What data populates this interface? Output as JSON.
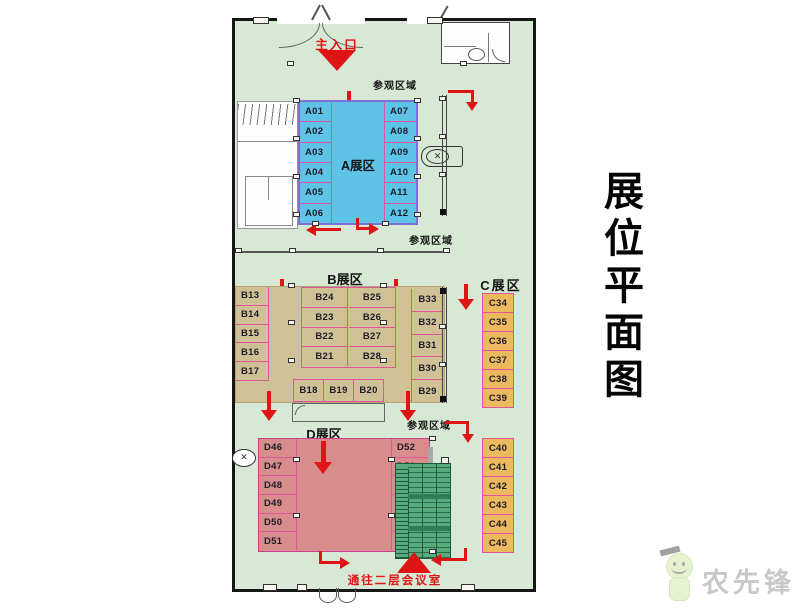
{
  "title": {
    "text": "展位平面图"
  },
  "plan": {
    "entrance": {
      "label": "主入口"
    },
    "visit_labels": {
      "top": "参观区域",
      "mid": "参观区域",
      "lower": "参观区域"
    },
    "exit_label": "通往二层会议室",
    "zone_a": {
      "label": "A展区",
      "left": [
        "A01",
        "A02",
        "A03",
        "A04",
        "A05",
        "A06"
      ],
      "right": [
        "A07",
        "A08",
        "A09",
        "A10",
        "A11",
        "A12"
      ]
    },
    "zone_b": {
      "label": "B展区",
      "left": [
        "B13",
        "B14",
        "B15",
        "B16",
        "B17"
      ],
      "center_left": [
        "B24",
        "B23",
        "B22",
        "B21"
      ],
      "center_right": [
        "B25",
        "B26",
        "B27",
        "B28"
      ],
      "bottom": [
        "B18",
        "B19",
        "B20"
      ],
      "right": [
        "B33",
        "B32",
        "B31",
        "B30",
        "B29"
      ]
    },
    "zone_c": {
      "label": "C展区",
      "top": [
        "C34",
        "C35",
        "C36",
        "C37",
        "C38",
        "C39"
      ],
      "bottom": [
        "C40",
        "C41",
        "C42",
        "C43",
        "C44",
        "C45"
      ]
    },
    "zone_d": {
      "label": "D展区",
      "left": [
        "D46",
        "D47",
        "D48",
        "D49",
        "D50",
        "D51"
      ],
      "right": [
        "D52",
        "D53",
        "D54",
        "D55",
        "D56",
        "D57"
      ]
    }
  },
  "colors": {
    "floor": "#d7e9d4",
    "zone_a": "#5fc2e7",
    "zone_a_border": "#7d6fd6",
    "zone_b": "#d0c096",
    "zone_c": "#ecb95e",
    "zone_d": "#d98c8c",
    "zone_d_border": "#cc3f8f",
    "booth_line": "#e0559c",
    "arrow_red": "#df1414",
    "escalator": "#57ab7d"
  },
  "watermark": {
    "text": "农先锋"
  }
}
